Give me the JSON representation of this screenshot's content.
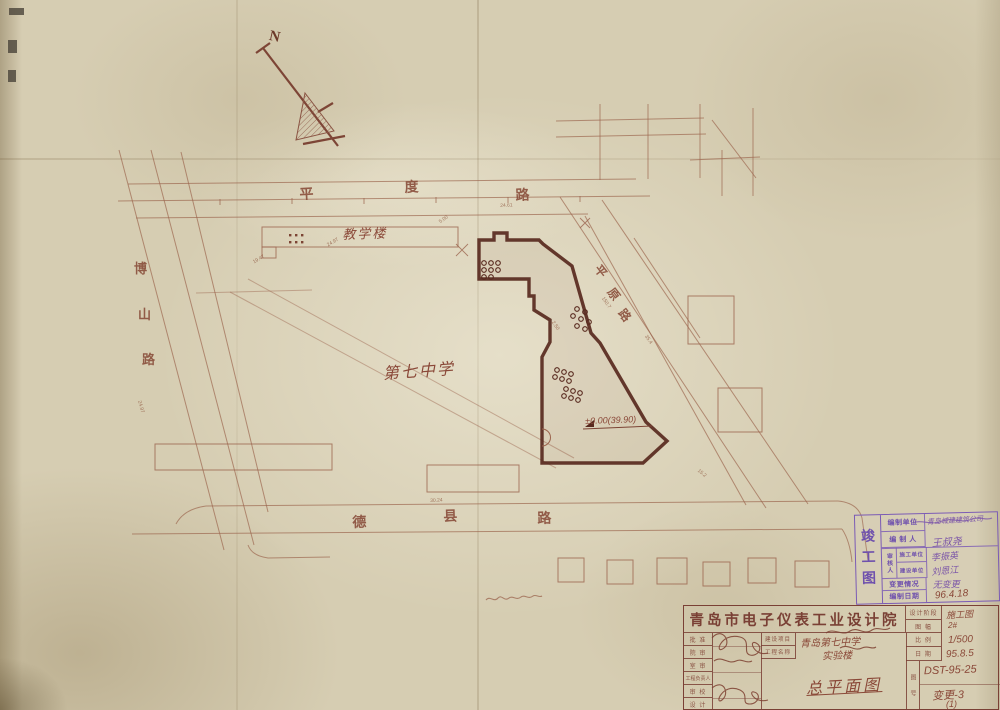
{
  "plan": {
    "north": "N",
    "streets": {
      "pingdu": {
        "name": "平度路",
        "c0": "平",
        "c1": "度",
        "c2": "路"
      },
      "boshan": {
        "name": "博山路",
        "c0": "博",
        "c1": "山",
        "c2": "路"
      },
      "dexian": {
        "name": "德县路",
        "c0": "德",
        "c1": "县",
        "c2": "路"
      },
      "pingyuan": {
        "name": "平原路",
        "c0": "平",
        "c1": "原",
        "c2": "路"
      }
    },
    "labels": {
      "teaching_building": "教学楼",
      "school": "第七中学",
      "level_mark": "±0.00(39.90)"
    },
    "dims": {
      "d0": "24.97",
      "d1": "19.47",
      "d2": "5.00",
      "d3": "24.61",
      "d4": "150.7",
      "d5": "35.4",
      "d6": "2.50",
      "d7": "30.24",
      "d8": "15.2",
      "d9": "24.97"
    },
    "colors": {
      "paper": "#d6cdb2",
      "ink_light": "#9b644d",
      "ink_dark": "#58291e",
      "stamp_purple": "#7b5bb5"
    }
  },
  "stamp": {
    "side": "竣工图",
    "unit_label": "编制单位",
    "unit_value": "青岛城建建筑公司",
    "author_label": "编 制 人",
    "author_value": "王叔尧",
    "review_label": "审核人",
    "sub1_label": "施工单位",
    "sub1_value": "李振英",
    "sub2_label": "建设单位",
    "sub2_value": "刘恩江",
    "change_label": "变更情况",
    "change_value": "无变更",
    "date_label": "编制日期",
    "date_value": "96.4.18"
  },
  "titleblock": {
    "institute": "青岛市电子仪表工业设计院",
    "stage_label": "设计阶段",
    "stage_value": "施工图",
    "sheet_label": "图 幅",
    "sheet_value": "2#",
    "rows": {
      "r0": "批 准",
      "r1": "院 审",
      "r2": "室 审",
      "r3": "工程负责人",
      "r4": "审 校",
      "r5": "设 计"
    },
    "project_label": "建设项目",
    "project_value": "青岛第七中学",
    "name_label": "工程名称",
    "name_value": "实验楼",
    "drawing_title": "总平面图",
    "scale_label": "比 例",
    "scale_value": "1/500",
    "date_label": "日 期",
    "date_value": "95.8.5",
    "figno_label": "图 号",
    "figno_value": "DST-95-25",
    "change_value": "变更-3",
    "change_sub": "(1)"
  }
}
